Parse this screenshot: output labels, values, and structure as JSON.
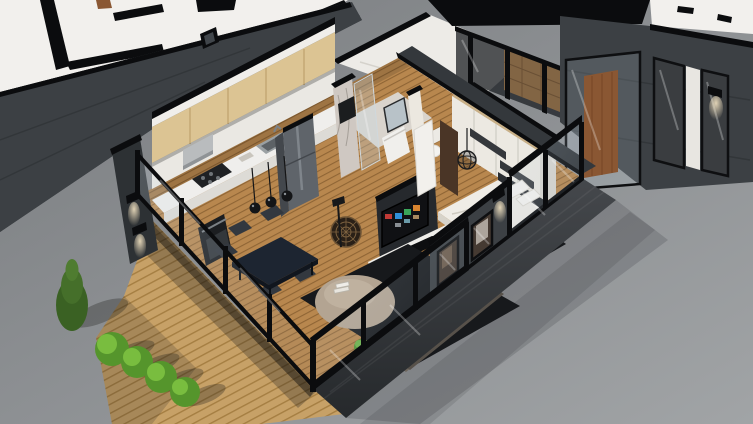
{
  "meta": {
    "title": "3D isometric cutaway floor plan render",
    "style": "architectural visualization, no on-screen text"
  },
  "colors": {
    "background": "#8d9093",
    "background_dark": "#7c7f82",
    "background_light": "#9fa2a4",
    "exterior_wall": "#3c4044",
    "exterior_wall_dark": "#2d3134",
    "wall_top": "#0b0c0e",
    "neighbor_floor": "#f2f0ed",
    "interior_wall": "#eae6dd",
    "white_plane": "#edebe7",
    "deck_wood": "#c7a167",
    "deck_wood_line": "#a57e42",
    "wood_floor": "#b8874e",
    "wood_floor_line": "#8f6535",
    "cabinet_wood": "#dcc493",
    "counter": "#efeeec",
    "appliance_black": "#1c1e21",
    "fridge": "#5f646a",
    "table": "#1d2531",
    "chair": "#33383f",
    "rug": "#17191c",
    "pouf": "#b3a492",
    "sofa": "#6e675e",
    "sofa_cushion": "#8a8276",
    "bed": "#efece6",
    "headboard": "#2b2e32",
    "bench": "#6e5742",
    "wardrobe": "#ece9e2",
    "wardrobe_stripe": "#35383c",
    "marble": "#cfc8c2",
    "bath_tile": "#d9d4cd",
    "tv_screen": "#101114",
    "shelf": "#efeeea",
    "door_wood": "#8a5733",
    "shower_tile": "#b98a55",
    "glass_frame": "#0e0f11",
    "bush": "#55952c",
    "bush_light": "#79bd3f",
    "conifer": "#3a6123",
    "plant": "#4e9430",
    "glow": "#ffeecb"
  },
  "scene": {
    "rooms": [
      {
        "name": "kitchen",
        "items": [
          "upper cabinets",
          "counter with sink",
          "gas hob",
          "range hood",
          "oven",
          "fridge",
          "pendant lights"
        ]
      },
      {
        "name": "dining area",
        "items": [
          "dark dining table",
          "five chairs",
          "round rattan decor",
          "floor lamp"
        ]
      },
      {
        "name": "living room",
        "items": [
          "corner sofa",
          "round pouf with books",
          "dark area rug",
          "wall tv with colorful menu",
          "media shelf with books",
          "green plant"
        ]
      },
      {
        "name": "bedroom",
        "items": [
          "double bed with white duvet",
          "pillows",
          "sliding-door wardrobe",
          "wooden bench",
          "wire pendant lamp",
          "dark rug"
        ]
      },
      {
        "name": "bathroom",
        "items": [
          "marble shower",
          "glass partition",
          "vanity with mirror",
          "wall-hung toilet"
        ]
      },
      {
        "name": "hallway",
        "items": [
          "open white door"
        ]
      }
    ],
    "exterior": {
      "terrace": "diagonal wooden plank deck",
      "landscaping": {
        "round_bushes": 4,
        "conifer_trees": 1
      },
      "shell": "dark gray cutaway walls with black cut edges and glass curtain walls with black mullions",
      "context": "adjacent units shown as empty white floor plates",
      "details": [
        "wall-mounted downlights",
        "wooden entrance door behind glass",
        "tan tiled shower box",
        "small facade window"
      ]
    }
  }
}
